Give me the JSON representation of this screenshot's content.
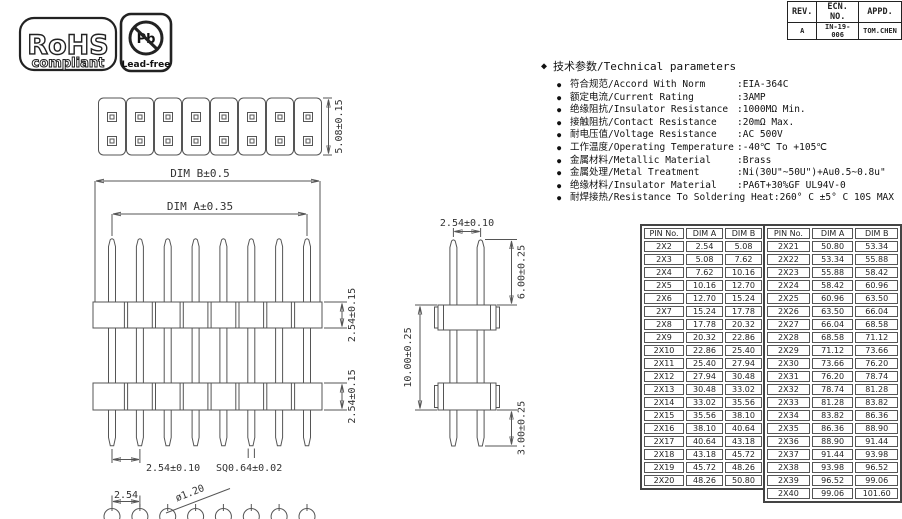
{
  "page": {
    "background": "#ffffff",
    "line_color": "#555555",
    "text_color": "#222222"
  },
  "logos": {
    "rohs": {
      "line1": "RoHS",
      "line2": "compliant"
    },
    "leadfree": {
      "symbol": "Pb",
      "label": "Lead-free"
    }
  },
  "rev_table": {
    "headers": [
      "REV.",
      "ECN. NO.",
      "APPD."
    ],
    "row": [
      "A",
      "IN-19-006",
      "TOM.CHEN"
    ]
  },
  "tech_params": {
    "title_bullet": "◆",
    "title": "技术参数/Technical parameters",
    "item_bullet": "●",
    "items": [
      {
        "label": "符合规范/Accord With Norm",
        "value": ":EIA-364C"
      },
      {
        "label": "额定电流/Current Rating",
        "value": ":3AMP"
      },
      {
        "label": "绝缘阻抗/Insulator Resistance",
        "value": ":1000MΩ Min."
      },
      {
        "label": "接触阻抗/Contact Resistance",
        "value": ":20mΩ Max."
      },
      {
        "label": "耐电压值/Voltage Resistance",
        "value": ":AC 500V"
      },
      {
        "label": "工作温度/Operating Temperature",
        "value": ":-40℃ To +105℃"
      },
      {
        "label": "金属材料/Metallic Material",
        "value": ":Brass"
      },
      {
        "label": "金属处理/Metal Treatment",
        "value": ":Ni(30U\"~50U\")+Au0.5~0.8u\""
      },
      {
        "label": "绝缘材料/Insulator Material",
        "value": ":PA6T+30%GF UL94V-0"
      },
      {
        "label": "耐焊接热/Resistance To Soldering Heat",
        "value": ":260° C ±5° C  10S MAX"
      }
    ]
  },
  "pin_tables": {
    "headers": [
      "PIN No.",
      "DIM A",
      "DIM B"
    ],
    "left_rows": [
      [
        "2X2",
        "2.54",
        "5.08"
      ],
      [
        "2X3",
        "5.08",
        "7.62"
      ],
      [
        "2X4",
        "7.62",
        "10.16"
      ],
      [
        "2X5",
        "10.16",
        "12.70"
      ],
      [
        "2X6",
        "12.70",
        "15.24"
      ],
      [
        "2X7",
        "15.24",
        "17.78"
      ],
      [
        "2X8",
        "17.78",
        "20.32"
      ],
      [
        "2X9",
        "20.32",
        "22.86"
      ],
      [
        "2X10",
        "22.86",
        "25.40"
      ],
      [
        "2X11",
        "25.40",
        "27.94"
      ],
      [
        "2X12",
        "27.94",
        "30.48"
      ],
      [
        "2X13",
        "30.48",
        "33.02"
      ],
      [
        "2X14",
        "33.02",
        "35.56"
      ],
      [
        "2X15",
        "35.56",
        "38.10"
      ],
      [
        "2X16",
        "38.10",
        "40.64"
      ],
      [
        "2X17",
        "40.64",
        "43.18"
      ],
      [
        "2X18",
        "43.18",
        "45.72"
      ],
      [
        "2X19",
        "45.72",
        "48.26"
      ],
      [
        "2X20",
        "48.26",
        "50.80"
      ]
    ],
    "right_rows": [
      [
        "2X21",
        "50.80",
        "53.34"
      ],
      [
        "2X22",
        "53.34",
        "55.88"
      ],
      [
        "2X23",
        "55.88",
        "58.42"
      ],
      [
        "2X24",
        "58.42",
        "60.96"
      ],
      [
        "2X25",
        "60.96",
        "63.50"
      ],
      [
        "2X26",
        "63.50",
        "66.04"
      ],
      [
        "2X27",
        "66.04",
        "68.58"
      ],
      [
        "2X28",
        "68.58",
        "71.12"
      ],
      [
        "2X29",
        "71.12",
        "73.66"
      ],
      [
        "2X30",
        "73.66",
        "76.20"
      ],
      [
        "2X31",
        "76.20",
        "78.74"
      ],
      [
        "2X32",
        "78.74",
        "81.28"
      ],
      [
        "2X33",
        "81.28",
        "83.82"
      ],
      [
        "2X34",
        "83.82",
        "86.36"
      ],
      [
        "2X35",
        "86.36",
        "88.90"
      ],
      [
        "2X36",
        "88.90",
        "91.44"
      ],
      [
        "2X37",
        "91.44",
        "93.98"
      ],
      [
        "2X38",
        "93.98",
        "96.52"
      ],
      [
        "2X39",
        "96.52",
        "99.06"
      ],
      [
        "2X40",
        "99.06",
        "101.60"
      ]
    ]
  },
  "drawing": {
    "top_view": {
      "row_spacing": "5.08±0.15",
      "dim_b": "DIM B±0.5",
      "dim_a": "DIM A±0.35"
    },
    "front_view": {
      "upper_insulator": "2.54±0.15",
      "lower_insulator": "2.54±0.15",
      "pin_pitch": "2.54±0.10",
      "pin_square": "SQ0.64±0.02"
    },
    "footprint": {
      "pad_pitch": "2.54",
      "hole_dia": "ø1.20"
    },
    "side_view": {
      "pin_pitch": "2.54±0.10",
      "top_length": "6.00±0.25",
      "body_span": "10.00±0.25",
      "tail_length": "3.00±0.25"
    }
  }
}
